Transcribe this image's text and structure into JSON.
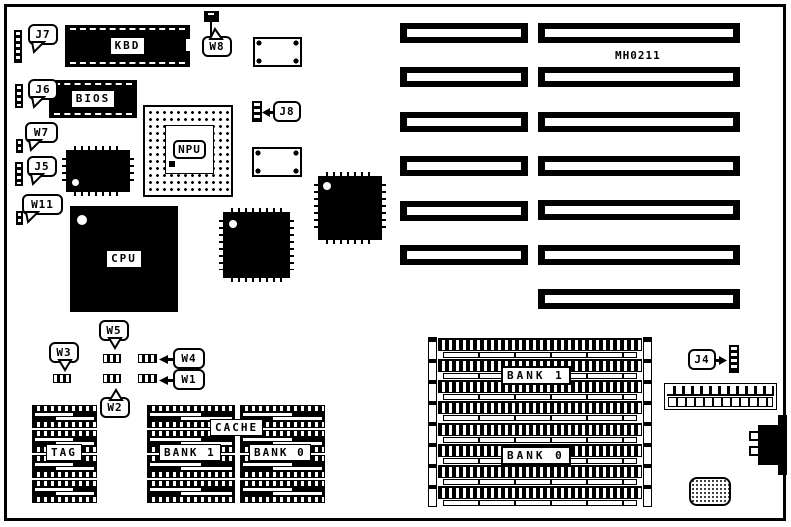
{
  "board": {
    "part_number": "MH0211"
  },
  "chips": {
    "kbd": "KBD",
    "bios": "BIOS",
    "npu": "NPU",
    "cpu": "CPU"
  },
  "cache": {
    "tag": "TAG",
    "cache": "CACHE",
    "bank1": "BANK 1",
    "bank0": "BANK 0",
    "chips_per_column": 4
  },
  "simm": {
    "bank1": "BANK 1",
    "bank0": "BANK 0",
    "rows": 8
  },
  "isa": {
    "left_count": 6,
    "right_count": 7
  },
  "callouts": {
    "j7": "J7",
    "j6": "J6",
    "w7": "W7",
    "j5": "J5",
    "w11": "W11",
    "w8": "W8",
    "j8": "J8",
    "w3": "W3",
    "w5": "W5",
    "w2": "W2",
    "w4": "W4",
    "w1": "W1",
    "j4": "J4"
  },
  "colors": {
    "ink": "#000000",
    "paper": "#ffffff"
  }
}
